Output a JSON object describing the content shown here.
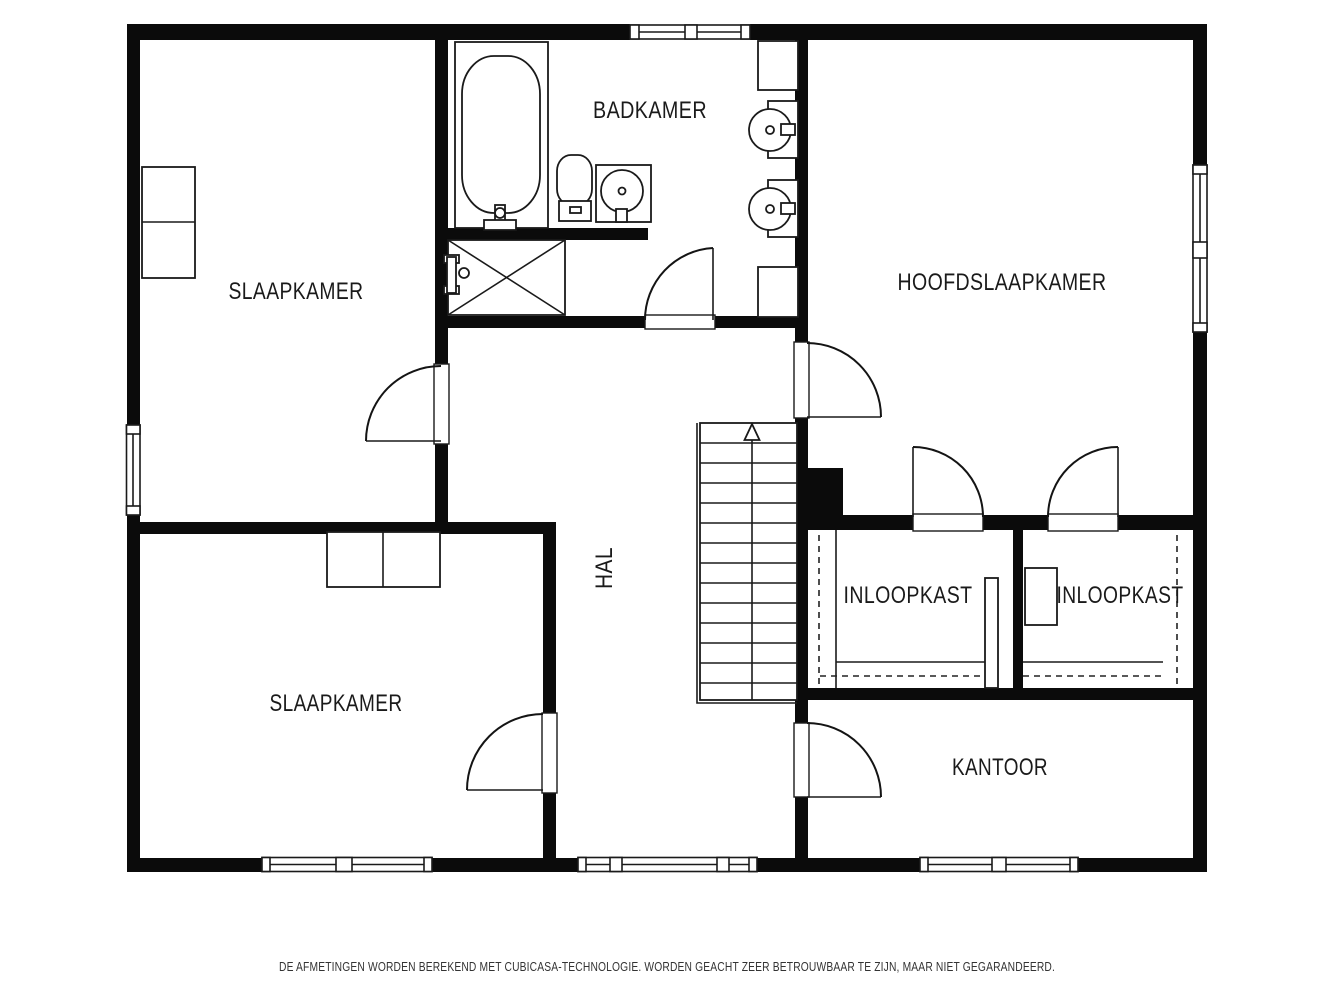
{
  "rooms": [
    {
      "id": "slaapkamer-top",
      "label": "SLAAPKAMER"
    },
    {
      "id": "badkamer",
      "label": "BADKAMER"
    },
    {
      "id": "hoofdslaapkamer",
      "label": "HOOFDSLAAPKAMER"
    },
    {
      "id": "hal",
      "label": "HAL"
    },
    {
      "id": "inloopkast-left",
      "label": "INLOOPKAST"
    },
    {
      "id": "inloopkast-right",
      "label": "INLOOPKAST"
    },
    {
      "id": "slaapkamer-bottom",
      "label": "SLAAPKAMER"
    },
    {
      "id": "kantoor",
      "label": "KANTOOR"
    }
  ],
  "fixtures": [
    {
      "name": "bathtub"
    },
    {
      "name": "toilet"
    },
    {
      "name": "sink-cabinet"
    },
    {
      "name": "round-basin",
      "count": 2
    },
    {
      "name": "shower"
    },
    {
      "name": "stairs-up"
    },
    {
      "name": "wardrobe",
      "count": 2
    }
  ],
  "footer": {
    "disclaimer": "DE AFMETINGEN WORDEN BEREKEND MET CUBICASA-TECHNOLOGIE. WORDEN GEACHT ZEER BETROUWBAAR TE ZIJN, MAAR NIET GEGARANDEERD."
  },
  "colors": {
    "wall": "#0b0b0b",
    "line": "#1a1a1a",
    "background": "#ffffff"
  }
}
